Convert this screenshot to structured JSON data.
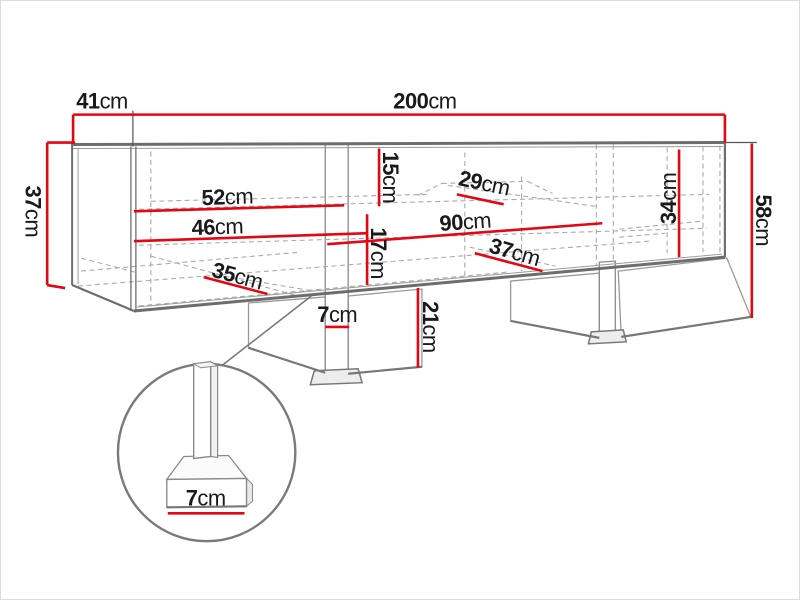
{
  "unit": "cm",
  "colors": {
    "dimension_line": "#e30613",
    "outline": "#6d6d6d",
    "thin_line": "#9a9a9a",
    "dashed": "#ababab",
    "text": "#1a1a1a"
  },
  "dims": {
    "width": {
      "value": "200",
      "unit": "cm"
    },
    "depth": {
      "value": "41",
      "unit": "cm"
    },
    "body_height": {
      "value": "37",
      "unit": "cm"
    },
    "total_height": {
      "value": "58",
      "unit": "cm"
    },
    "left_shelf_upper": {
      "value": "52",
      "unit": "cm"
    },
    "left_shelf_lower": {
      "value": "46",
      "unit": "cm"
    },
    "left_bottom_depth": {
      "value": "35",
      "unit": "cm"
    },
    "middle_top_height": {
      "value": "15",
      "unit": "cm"
    },
    "middle_shelf_depth": {
      "value": "29",
      "unit": "cm"
    },
    "middle_width": {
      "value": "90",
      "unit": "cm"
    },
    "middle_lower_height": {
      "value": "17",
      "unit": "cm"
    },
    "middle_bottom_depth": {
      "value": "37",
      "unit": "cm"
    },
    "divider_width": {
      "value": "7",
      "unit": "cm"
    },
    "leg_height": {
      "value": "21",
      "unit": "cm"
    },
    "right_inner_height": {
      "value": "34",
      "unit": "cm"
    },
    "foot_detail_width": {
      "value": "7",
      "unit": "cm"
    }
  }
}
